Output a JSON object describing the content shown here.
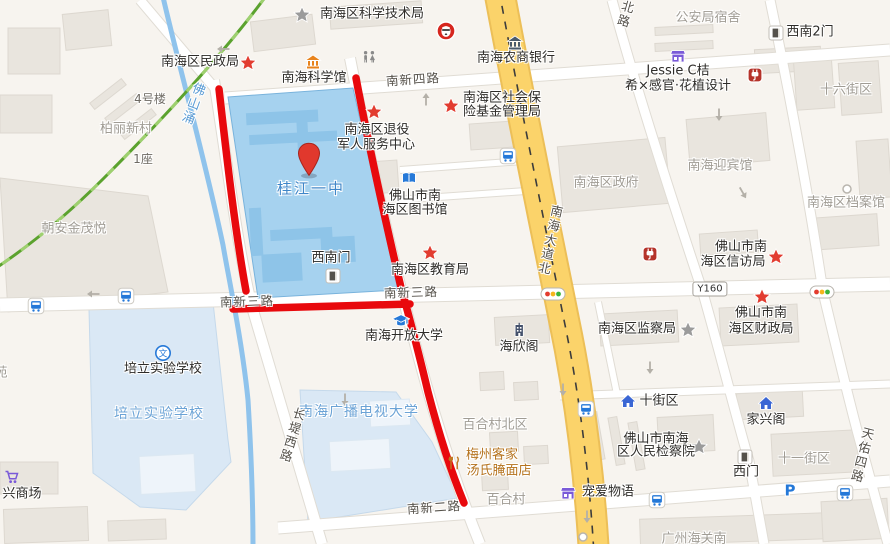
{
  "map": {
    "width": 890,
    "height": 544,
    "selected_poi": "桂江一中",
    "colors": {
      "background": "#f7f4ef",
      "route_red": "#e8090d",
      "campus_selected": "#a6d2ef",
      "campus_light": "#dae8f5",
      "river_blue": "#8fc3ec",
      "rail_green": "#5ba22e",
      "road_yellow": "#fbd36a",
      "poi_text": "#2e2c29",
      "area_text": "#a09c94"
    },
    "labels": [
      {
        "t": "南海区科学技术局",
        "x": 372,
        "y": 15,
        "c": "poi"
      },
      {
        "t": "公安局宿舍",
        "x": 708,
        "y": 19,
        "c": "gray"
      },
      {
        "t": "西南2门",
        "x": 810,
        "y": 33,
        "c": "poi"
      },
      {
        "t": "南海区民政局",
        "x": 200,
        "y": 63,
        "c": "poi"
      },
      {
        "t": "南海农商银行",
        "x": 516,
        "y": 59,
        "c": "poi"
      },
      {
        "t": "Jessie C桔",
        "x": 678,
        "y": 72,
        "c": "poi"
      },
      {
        "t": "希×感官·花植设计",
        "x": 678,
        "y": 87,
        "c": "poi"
      },
      {
        "t": "南海科学馆",
        "x": 314,
        "y": 79,
        "c": "poi"
      },
      {
        "t": "南新四路",
        "x": 413,
        "y": 80,
        "c": "road",
        "r": -4
      },
      {
        "t": "十六街区",
        "x": 846,
        "y": 91,
        "c": "gray"
      },
      {
        "t": "南海区社会保",
        "x": 502,
        "y": 99,
        "c": "poi"
      },
      {
        "t": "险基金管理局",
        "x": 502,
        "y": 113,
        "c": "poi"
      },
      {
        "t": "4号楼",
        "x": 150,
        "y": 100,
        "c": "dim"
      },
      {
        "t": "柏丽新村",
        "x": 126,
        "y": 130,
        "c": "gray"
      },
      {
        "t": "南海区退役",
        "x": 377,
        "y": 131,
        "c": "poi"
      },
      {
        "t": "军人服务中心",
        "x": 376,
        "y": 146,
        "c": "poi"
      },
      {
        "t": "1座",
        "x": 143,
        "y": 160,
        "c": "dim"
      },
      {
        "t": "佛山涌",
        "x": 191,
        "y": 103,
        "c": "river",
        "v": 1,
        "r": 20
      },
      {
        "t": "北路",
        "x": 624,
        "y": 14,
        "c": "road",
        "v": 1,
        "r": 16
      },
      {
        "t": "南海迎宾馆",
        "x": 720,
        "y": 167,
        "c": "gray"
      },
      {
        "t": "南海区政府",
        "x": 606,
        "y": 184,
        "c": "gray"
      },
      {
        "t": "桂江一中",
        "x": 311,
        "y": 189,
        "c": "blue"
      },
      {
        "t": "佛山市南",
        "x": 415,
        "y": 197,
        "c": "poi"
      },
      {
        "t": "海区图书馆",
        "x": 415,
        "y": 211,
        "c": "poi"
      },
      {
        "t": "南海区档案馆",
        "x": 846,
        "y": 204,
        "c": "gray"
      },
      {
        "t": "朝安金茂悦",
        "x": 74,
        "y": 230,
        "c": "gray"
      },
      {
        "t": "南海大道北",
        "x": 549,
        "y": 240,
        "c": "road",
        "v": 1,
        "r": 12
      },
      {
        "t": "佛山市南",
        "x": 741,
        "y": 248,
        "c": "poi"
      },
      {
        "t": "海区信访局",
        "x": 733,
        "y": 263,
        "c": "poi"
      },
      {
        "t": "南海区教育局",
        "x": 430,
        "y": 271,
        "c": "poi"
      },
      {
        "t": "西南门",
        "x": 331,
        "y": 259,
        "c": "poi"
      },
      {
        "t": "南新三路",
        "x": 247,
        "y": 302,
        "c": "road",
        "r": -2
      },
      {
        "t": "南新三路",
        "x": 411,
        "y": 293,
        "c": "road",
        "r": -2
      },
      {
        "t": "佛山市南",
        "x": 761,
        "y": 314,
        "c": "poi"
      },
      {
        "t": "海区财政局",
        "x": 761,
        "y": 330,
        "c": "poi"
      },
      {
        "t": "南海区监察局",
        "x": 637,
        "y": 330,
        "c": "poi"
      },
      {
        "t": "南海开放大学",
        "x": 404,
        "y": 337,
        "c": "poi"
      },
      {
        "t": "海欣阁",
        "x": 519,
        "y": 348,
        "c": "poi"
      },
      {
        "t": "培立实验学校",
        "x": 163,
        "y": 370,
        "c": "poi"
      },
      {
        "t": "苑",
        "x": 1,
        "y": 374,
        "c": "gray"
      },
      {
        "t": "培立实验学校",
        "x": 159,
        "y": 414,
        "c": "bluearea"
      },
      {
        "t": "十街区",
        "x": 659,
        "y": 402,
        "c": "poi"
      },
      {
        "t": "南海广播电视大学",
        "x": 359,
        "y": 412,
        "c": "bluearea"
      },
      {
        "t": "家兴阁",
        "x": 766,
        "y": 421,
        "c": "poi"
      },
      {
        "t": "百合村北区",
        "x": 495,
        "y": 426,
        "c": "gray"
      },
      {
        "t": "长堤西路",
        "x": 291,
        "y": 435,
        "c": "road",
        "v": 1,
        "r": 17
      },
      {
        "t": "佛山市南海",
        "x": 656,
        "y": 440,
        "c": "poi"
      },
      {
        "t": "区人民检察院",
        "x": 656,
        "y": 453,
        "c": "poi"
      },
      {
        "t": "天佑四路",
        "x": 861,
        "y": 455,
        "c": "road",
        "v": 1,
        "r": 14
      },
      {
        "t": "十一街区",
        "x": 804,
        "y": 460,
        "c": "gray"
      },
      {
        "t": "梅州客家",
        "x": 492,
        "y": 456,
        "c": "orange"
      },
      {
        "t": "汤氏腌面店",
        "x": 499,
        "y": 472,
        "c": "orange"
      },
      {
        "t": "西门",
        "x": 746,
        "y": 473,
        "c": "poi"
      },
      {
        "t": "宠爱物语",
        "x": 608,
        "y": 493,
        "c": "poi"
      },
      {
        "t": "兴商场",
        "x": 22,
        "y": 495,
        "c": "poi"
      },
      {
        "t": "百合村",
        "x": 506,
        "y": 501,
        "c": "gray"
      },
      {
        "t": "南新二路",
        "x": 434,
        "y": 508,
        "c": "road",
        "r": -4
      },
      {
        "t": "广州海关南",
        "x": 694,
        "y": 540,
        "c": "gray"
      }
    ],
    "badges": [
      {
        "text": "Y160",
        "x": 710,
        "y": 289
      }
    ],
    "icons": [
      {
        "t": "star-gray",
        "x": 302,
        "y": 15
      },
      {
        "t": "star-red",
        "x": 248,
        "y": 63
      },
      {
        "t": "museum",
        "x": 313,
        "y": 62
      },
      {
        "t": "kfc",
        "x": 446,
        "y": 31
      },
      {
        "t": "bank",
        "x": 515,
        "y": 43
      },
      {
        "t": "restroom",
        "x": 369,
        "y": 57
      },
      {
        "t": "door",
        "x": 776,
        "y": 33
      },
      {
        "t": "shop",
        "x": 678,
        "y": 56
      },
      {
        "t": "plug",
        "x": 755,
        "y": 75
      },
      {
        "t": "star-red",
        "x": 451,
        "y": 106
      },
      {
        "t": "star-red",
        "x": 374,
        "y": 112
      },
      {
        "t": "bus",
        "x": 508,
        "y": 156
      },
      {
        "t": "library",
        "x": 409,
        "y": 178
      },
      {
        "t": "dot",
        "x": 847,
        "y": 189
      },
      {
        "t": "star-red",
        "x": 430,
        "y": 253
      },
      {
        "t": "plug",
        "x": 650,
        "y": 254
      },
      {
        "t": "star-red",
        "x": 776,
        "y": 257
      },
      {
        "t": "door",
        "x": 333,
        "y": 276
      },
      {
        "t": "traffic",
        "x": 553,
        "y": 294
      },
      {
        "t": "traffic",
        "x": 822,
        "y": 292
      },
      {
        "t": "bus",
        "x": 36,
        "y": 306
      },
      {
        "t": "bus",
        "x": 126,
        "y": 296
      },
      {
        "t": "star-red",
        "x": 762,
        "y": 297
      },
      {
        "t": "star-gray",
        "x": 688,
        "y": 330
      },
      {
        "t": "gradcap",
        "x": 401,
        "y": 321
      },
      {
        "t": "building",
        "x": 519,
        "y": 330
      },
      {
        "t": "wen",
        "x": 163,
        "y": 353
      },
      {
        "t": "house",
        "x": 628,
        "y": 401
      },
      {
        "t": "house",
        "x": 766,
        "y": 403
      },
      {
        "t": "bus",
        "x": 586,
        "y": 409
      },
      {
        "t": "star-gray",
        "x": 699,
        "y": 447
      },
      {
        "t": "door",
        "x": 745,
        "y": 457
      },
      {
        "t": "restaurant",
        "x": 454,
        "y": 463
      },
      {
        "t": "cart",
        "x": 12,
        "y": 477
      },
      {
        "t": "parking",
        "x": 790,
        "y": 490
      },
      {
        "t": "shop",
        "x": 568,
        "y": 493
      },
      {
        "t": "bus",
        "x": 657,
        "y": 500
      },
      {
        "t": "bus",
        "x": 845,
        "y": 493
      },
      {
        "t": "dot",
        "x": 583,
        "y": 537
      },
      {
        "t": "arrow",
        "x": 223,
        "y": 49,
        "r": 180
      },
      {
        "t": "arrow",
        "x": 93,
        "y": 294,
        "r": 180
      },
      {
        "t": "arrow",
        "x": 426,
        "y": 99,
        "r": -90
      },
      {
        "t": "arrow",
        "x": 719,
        "y": 115,
        "r": 90
      },
      {
        "t": "arrow",
        "x": 743,
        "y": 193,
        "r": 60
      },
      {
        "t": "arrow",
        "x": 650,
        "y": 368,
        "r": 90
      },
      {
        "t": "arrow",
        "x": 563,
        "y": 390,
        "r": 90
      },
      {
        "t": "arrow",
        "x": 587,
        "y": 517,
        "r": 90
      },
      {
        "t": "arrow",
        "x": 345,
        "y": 400,
        "r": 90
      },
      {
        "t": "pin",
        "x": 309,
        "y": 177
      }
    ],
    "geometry": {
      "roads_white": [
        {
          "p": "M225,98 L890,50",
          "w": 11
        },
        {
          "p": "M0,305 L890,284",
          "w": 13
        },
        {
          "p": "M278,528 L890,481",
          "w": 11
        },
        {
          "p": "M140,0 L218,92",
          "w": 9
        },
        {
          "p": "M214,80 C228,170 238,250 252,307 L322,544",
          "w": 10
        },
        {
          "p": "M350,58 C368,150 386,230 403,297 C420,365 444,455 480,544",
          "w": 10
        },
        {
          "p": "M612,0 C638,95 672,200 703,293 C722,360 737,420 749,461 L764,544",
          "w": 9
        },
        {
          "p": "M770,0 C792,105 810,205 823,292 C838,355 849,400 858,434 L888,544",
          "w": 9
        },
        {
          "p": "M400,170 L537,160",
          "w": 6
        },
        {
          "p": "M396,200 L540,190",
          "w": 6
        },
        {
          "p": "M560,396 L890,384",
          "w": 7
        },
        {
          "p": "M598,302 L617,394",
          "w": 6
        }
      ],
      "road_yellow": {
        "p": "M499,-10 C523,120 548,240 564,320 C579,392 589,470 594,554",
        "w": 28
      },
      "river": "M163,-3 C180,70 205,160 223,245 C228,275 242,340 248,400 C251,450 253,500 253,547",
      "rail_green": "M266,-4 C225,52 160,122 104,178 C68,214 32,244 -4,268",
      "route_segments": [
        "M219,89 C227,160 235,230 246,291",
        "M233,309 L410,304",
        "M356,78 C370,152 387,228 403,296",
        "M404,298 C414,335 421,362 428,392 C441,442 452,474 464,503"
      ],
      "campus_selected": "228,97 353,88 398,290 258,298",
      "campus_light": [
        "89,309 213,302 228,440 231,462 186,510 140,507 93,473",
        "300,390 396,392 432,442 458,498 308,522"
      ],
      "campus_inner": [
        [
          250,
          110,
          72,
          12
        ],
        [
          252,
          132,
          88,
          10
        ],
        [
          248,
          205,
          12,
          48
        ],
        [
          268,
          228,
          62,
          11
        ],
        [
          318,
          238,
          34,
          26
        ],
        [
          258,
          252,
          40,
          28
        ],
        [
          300,
          118,
          11,
          40
        ]
      ],
      "block_poly": "0,178 148,196 168,292 8,312",
      "buildings": [
        [
          8,
          28,
          52,
          46,
          0
        ],
        [
          64,
          12,
          46,
          36,
          -6
        ],
        [
          0,
          95,
          52,
          38,
          0
        ],
        [
          88,
          90,
          40,
          8,
          -38
        ],
        [
          103,
          105,
          40,
          8,
          -38
        ],
        [
          118,
          120,
          40,
          8,
          -38
        ],
        [
          60,
          226,
          52,
          30,
          -4
        ],
        [
          252,
          18,
          62,
          30,
          -7
        ],
        [
          330,
          4,
          92,
          22,
          -4
        ],
        [
          655,
          26,
          58,
          8,
          -3
        ],
        [
          655,
          42,
          58,
          8,
          -3
        ],
        [
          755,
          48,
          66,
          24,
          -3
        ],
        [
          795,
          55,
          38,
          54,
          -4
        ],
        [
          840,
          62,
          40,
          52,
          -4
        ],
        [
          470,
          122,
          58,
          26,
          -4
        ],
        [
          340,
          162,
          58,
          32,
          -4
        ],
        [
          560,
          142,
          108,
          66,
          -5
        ],
        [
          688,
          116,
          80,
          48,
          -5
        ],
        [
          858,
          140,
          32,
          58,
          -4
        ],
        [
          810,
          216,
          68,
          32,
          -4
        ],
        [
          700,
          232,
          58,
          22,
          -4
        ],
        [
          600,
          312,
          78,
          32,
          -3
        ],
        [
          720,
          306,
          78,
          38,
          -3
        ],
        [
          495,
          316,
          54,
          28,
          -3
        ],
        [
          480,
          372,
          24,
          18,
          -3
        ],
        [
          514,
          382,
          24,
          18,
          -3
        ],
        [
          490,
          432,
          28,
          20,
          -3
        ],
        [
          524,
          446,
          24,
          18,
          -3
        ],
        [
          482,
          472,
          26,
          18,
          -3
        ],
        [
          592,
          412,
          9,
          48,
          -10
        ],
        [
          612,
          417,
          9,
          48,
          -10
        ],
        [
          632,
          422,
          9,
          48,
          -10
        ],
        [
          658,
          416,
          56,
          36,
          -3
        ],
        [
          737,
          392,
          66,
          26,
          -3
        ],
        [
          772,
          432,
          86,
          42,
          -3
        ],
        [
          640,
          516,
          186,
          26,
          -2
        ],
        [
          822,
          500,
          66,
          40,
          -3
        ],
        [
          0,
          462,
          58,
          32,
          0
        ],
        [
          4,
          508,
          84,
          34,
          -2
        ],
        [
          108,
          520,
          58,
          20,
          -2
        ]
      ],
      "light_buildings": [
        [
          140,
          455,
          55,
          38,
          -3
        ],
        [
          330,
          440,
          60,
          30,
          -3
        ],
        [
          370,
          400,
          40,
          26,
          -3
        ]
      ]
    }
  }
}
